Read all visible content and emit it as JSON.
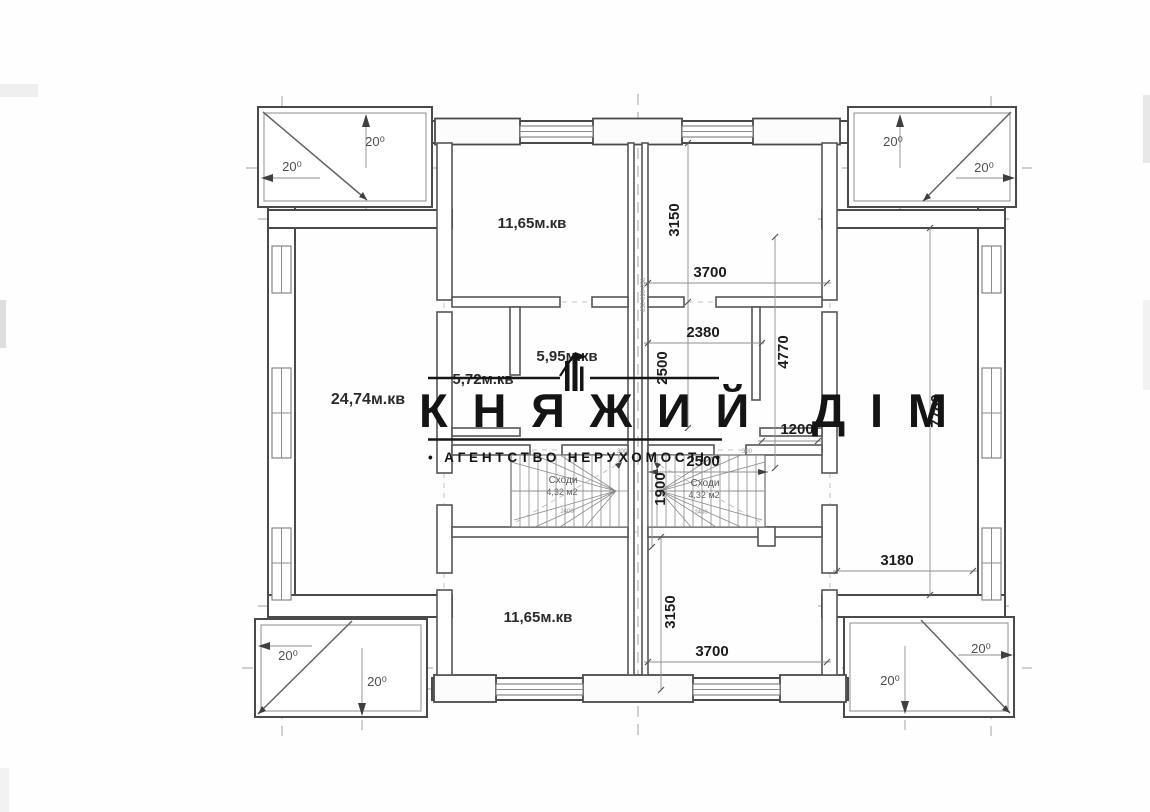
{
  "watermark": {
    "title": "КНЯЖИЙ ДІМ",
    "subtitle": "• АГЕНТСТВО НЕРУХОМОСТІ •",
    "logo": "castle-towers-icon"
  },
  "rooms": {
    "bedroom_top": "11,65м.кв",
    "bedroom_bottom": "11,65м.кв",
    "hall": "5,72м.кв",
    "hall2": "5,95м.кв",
    "living": "24,74м.кв"
  },
  "stairs": {
    "label": "Сходи",
    "area": "4,32 м2",
    "width": "2400"
  },
  "dims": {
    "d3700": "3700",
    "d3150": "3150",
    "d2380": "2380",
    "d2500": "2500",
    "d4770": "4770",
    "d1200": "1200",
    "d1900": "1900",
    "d7780": "7780",
    "d3180": "3180",
    "t300": "300",
    "chain": "050-090-050"
  },
  "balcony": {
    "angle": "20⁰"
  }
}
